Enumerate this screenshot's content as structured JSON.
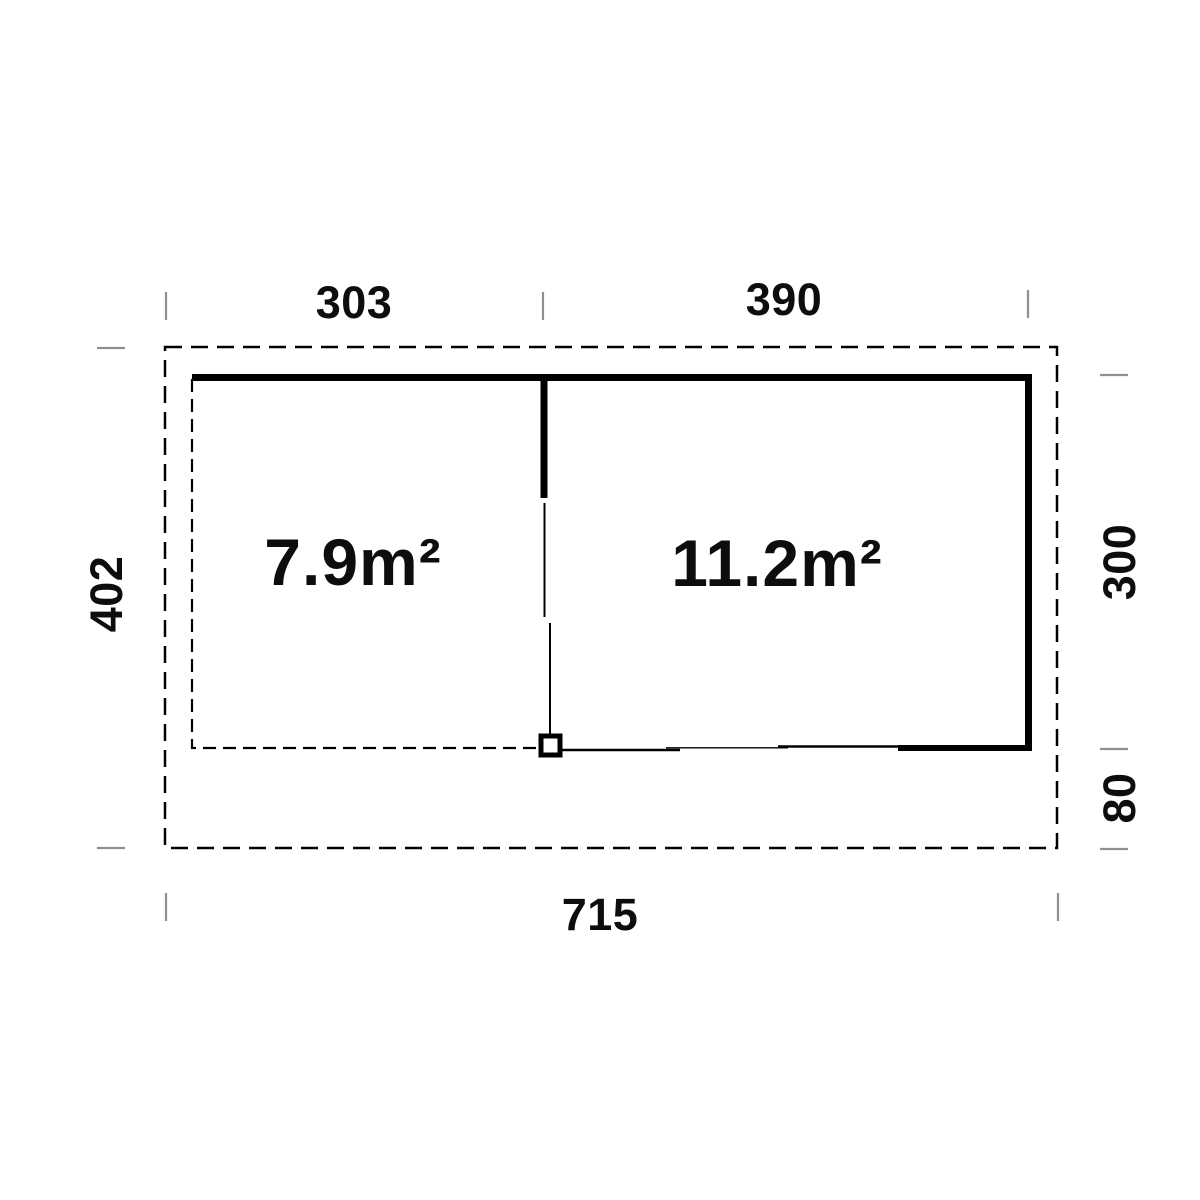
{
  "plan": {
    "rooms": [
      {
        "name": "left-room",
        "area_label": "7.9m²"
      },
      {
        "name": "right-room",
        "area_label": "11.2m²"
      }
    ],
    "dimensions": {
      "top_left_width": "303",
      "top_right_width": "390",
      "total_depth": "402",
      "main_depth": "300",
      "overhang_depth": "80",
      "total_width": "715"
    },
    "colors": {
      "line": "#000000",
      "tick": "#8f8f8f",
      "text": "#0d0d0d",
      "background": "#ffffff"
    }
  }
}
